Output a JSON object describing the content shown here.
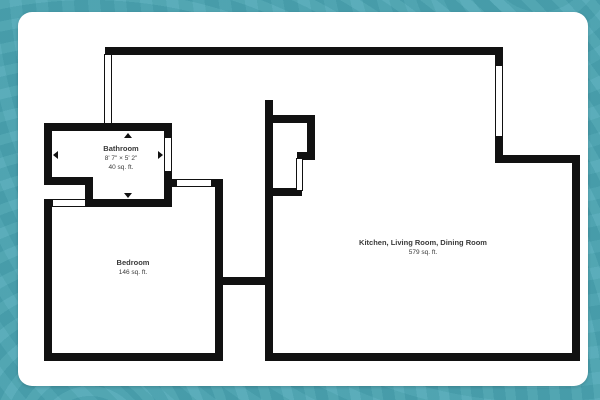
{
  "colors": {
    "frame_teal": "#4ba6b4",
    "card_white": "#ffffff",
    "wall_black": "#111111",
    "label_text": "#3a3a3a"
  },
  "plan": {
    "rooms": [
      {
        "id": "bathroom",
        "name": "Bathroom",
        "dimensions": "8' 7\" × 5' 2\"",
        "area": "40 sq. ft."
      },
      {
        "id": "bedroom",
        "name": "Bedroom",
        "area": "146 sq. ft."
      },
      {
        "id": "kitchen-living-dining",
        "name": "Kitchen, Living Room, Dining Room",
        "area": "579 sq. ft."
      }
    ],
    "walls": [
      {
        "name": "wall-top",
        "x": 105,
        "y": 47,
        "w": 398,
        "h": 8
      },
      {
        "name": "wall-bathroom-top",
        "x": 44,
        "y": 123,
        "w": 128,
        "h": 8
      },
      {
        "name": "wall-bathroom-left",
        "x": 44,
        "y": 123,
        "w": 8,
        "h": 62
      },
      {
        "name": "wall-bathroom-step-bottom",
        "x": 44,
        "y": 177,
        "w": 49,
        "h": 8
      },
      {
        "name": "wall-bathroom-step-right",
        "x": 85,
        "y": 177,
        "w": 8,
        "h": 30
      },
      {
        "name": "wall-bathroom-bottom",
        "x": 85,
        "y": 199,
        "w": 87,
        "h": 8
      },
      {
        "name": "wall-bathroom-right",
        "x": 164,
        "y": 123,
        "w": 8,
        "h": 84
      },
      {
        "name": "wall-hall-top",
        "x": 164,
        "y": 179,
        "w": 59,
        "h": 8
      },
      {
        "name": "wall-bedroom-right",
        "x": 215,
        "y": 179,
        "w": 8,
        "h": 182
      },
      {
        "name": "wall-bedroom-left",
        "x": 44,
        "y": 199,
        "w": 8,
        "h": 162
      },
      {
        "name": "wall-bedroom-bottom",
        "x": 44,
        "y": 353,
        "w": 179,
        "h": 8
      },
      {
        "name": "wall-connector",
        "x": 215,
        "y": 277,
        "w": 58,
        "h": 8
      },
      {
        "name": "wall-main-left",
        "x": 265,
        "y": 100,
        "w": 8,
        "h": 261
      },
      {
        "name": "wall-closet-top",
        "x": 265,
        "y": 115,
        "w": 50,
        "h": 8
      },
      {
        "name": "wall-closet-right",
        "x": 307,
        "y": 115,
        "w": 8,
        "h": 45
      },
      {
        "name": "wall-closet-jog",
        "x": 297,
        "y": 152,
        "w": 18,
        "h": 8
      },
      {
        "name": "wall-closet-bottom",
        "x": 265,
        "y": 188,
        "w": 37,
        "h": 8
      },
      {
        "name": "wall-main-topright-upper",
        "x": 495,
        "y": 55,
        "w": 8,
        "h": 12
      },
      {
        "name": "wall-main-topright-lower",
        "x": 495,
        "y": 135,
        "w": 8,
        "h": 28
      },
      {
        "name": "wall-main-topright-horizontal",
        "x": 495,
        "y": 155,
        "w": 85,
        "h": 8
      },
      {
        "name": "wall-main-right",
        "x": 572,
        "y": 155,
        "w": 8,
        "h": 206
      },
      {
        "name": "wall-main-bottom",
        "x": 265,
        "y": 353,
        "w": 315,
        "h": 8
      }
    ],
    "windows": [
      {
        "name": "window-entry-left",
        "x": 104,
        "y": 54,
        "w": 8,
        "h": 70
      },
      {
        "name": "window-bathroom-right",
        "x": 164,
        "y": 137,
        "w": 8,
        "h": 35
      },
      {
        "name": "window-hall-top",
        "x": 176,
        "y": 179,
        "w": 36,
        "h": 8
      },
      {
        "name": "window-bedroom-top",
        "x": 52,
        "y": 199,
        "w": 34,
        "h": 8
      },
      {
        "name": "window-main-topright",
        "x": 495,
        "y": 65,
        "w": 8,
        "h": 72
      },
      {
        "name": "door-closet",
        "x": 296,
        "y": 158,
        "w": 7,
        "h": 33
      }
    ],
    "dimension_arrows": [
      {
        "dir": "up",
        "x": 124,
        "y": 133
      },
      {
        "dir": "down",
        "x": 124,
        "y": 193
      },
      {
        "dir": "left",
        "x": 53,
        "y": 151
      },
      {
        "dir": "right",
        "x": 158,
        "y": 151
      }
    ]
  }
}
